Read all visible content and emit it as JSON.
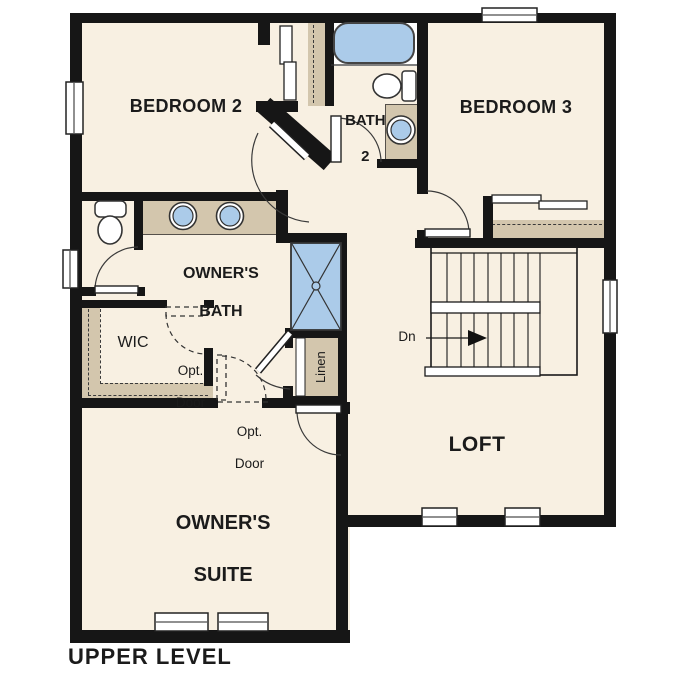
{
  "title": {
    "label": "UPPER LEVEL"
  },
  "palette": {
    "floor": "#f8f0e2",
    "cabinet_tan": "#d3c6ad",
    "fixture_blue": "#abcbe9",
    "wall_black": "#161616",
    "line": "#333333",
    "background": "#ffffff"
  },
  "rooms": {
    "bedroom2": {
      "label": "BEDROOM 2"
    },
    "bath2": {
      "line1": "BATH",
      "line2": "2"
    },
    "bedroom3": {
      "label": "BEDROOM 3"
    },
    "owners_bath": {
      "line1": "OWNER'S",
      "line2": "BATH"
    },
    "wic": {
      "label": "WIC"
    },
    "linen": {
      "label": "Linen"
    },
    "loft": {
      "label": "LOFT"
    },
    "owners_suite": {
      "line1": "OWNER'S",
      "line2": "SUITE"
    }
  },
  "annotations": {
    "opt_door_upper": {
      "line1": "Opt.",
      "line2": "Door"
    },
    "opt_door_lower": {
      "line1": "Opt.",
      "line2": "Door"
    },
    "stair_direction": {
      "label": "Dn"
    }
  },
  "fixtures": {
    "bath2": [
      "bathtub",
      "toilet",
      "vanity-sink"
    ],
    "owners_bath": [
      "toilet",
      "double-vanity-sinks",
      "shower"
    ],
    "stairs": "u-shaped-staircase-down",
    "closets": [
      "bedroom2-closet",
      "bedroom3-closet",
      "wic-shelving",
      "linen-closet"
    ]
  }
}
